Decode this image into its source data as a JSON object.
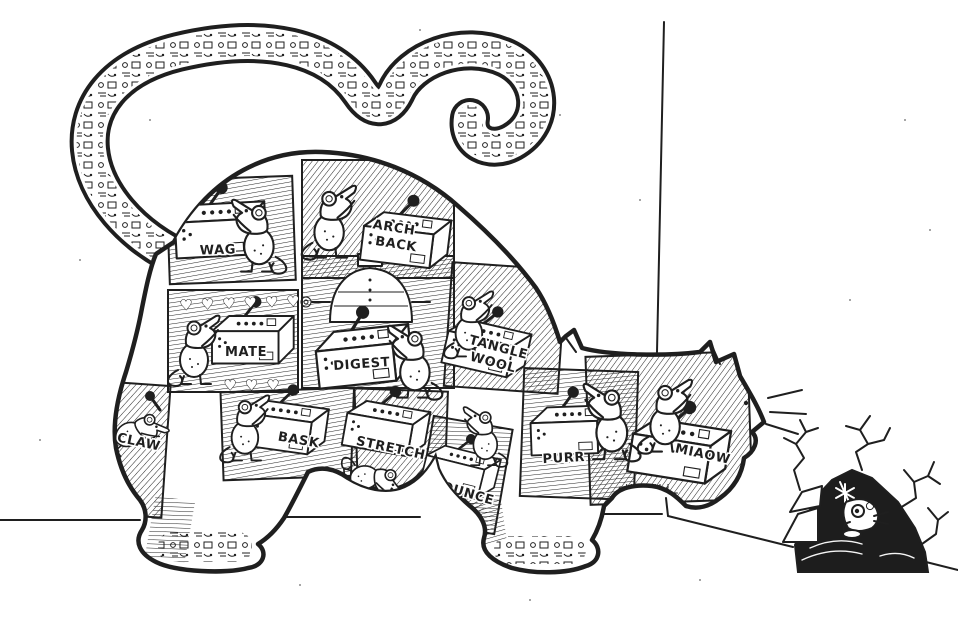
{
  "colors": {
    "ink": "#1f1f1f",
    "paper": "#ffffff"
  },
  "figure": {
    "compartment_labels": {
      "wag": "WAG",
      "arch_back": [
        "ARCH",
        "BACK"
      ],
      "mate": "MATE",
      "digest": "DIGEST",
      "tangle_wool": [
        "TANGLE",
        "WOOL"
      ],
      "claw": "CLAW",
      "bask": "BASK",
      "stretch": "STRETCH",
      "pounce": "POUNCE",
      "purr": "PURR",
      "miaow": "MIAOW"
    },
    "decor": {
      "mate_hearts_top": "♥ ♥ ♥ ♥ ♥ ♥",
      "mate_hearts_bottom": "♥ ♥ ♥"
    }
  }
}
